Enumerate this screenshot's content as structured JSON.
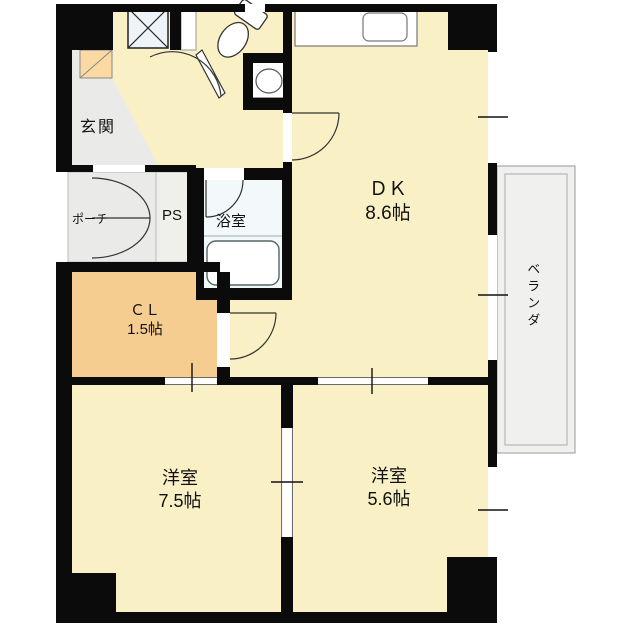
{
  "floorplan": {
    "type": "apartment-floorplan",
    "rooms": {
      "genkan": {
        "name": "玄関"
      },
      "porch": {
        "name": "ポーチ"
      },
      "pipe_space": {
        "name": "PS"
      },
      "bathroom": {
        "name": "浴室"
      },
      "closet": {
        "name": "ＣＬ",
        "size": "1.5帖"
      },
      "dining_kitchen": {
        "name": "ＤＫ",
        "size": "8.6帖"
      },
      "western_room_large": {
        "name": "洋室",
        "size": "7.5帖"
      },
      "western_room_small": {
        "name": "洋室",
        "size": "5.6帖"
      },
      "veranda": {
        "name": "ベランダ"
      }
    },
    "fixtures": [
      "toilet-icon",
      "washbasin-icon",
      "bathtub-icon",
      "kitchen-counter-icon",
      "kitchen-sink-icon",
      "washing-machine-space-icon",
      "shoe-cabinet-icon",
      "door-swing-arc",
      "window-opening"
    ],
    "colors": {
      "wall": "#0b0b0b",
      "room_cream": "#faf0c6",
      "closet_orange": "#f6cd90",
      "entry_gray": "#eaeae8",
      "bath_white": "#f3f8fa",
      "veranda_gray": "#f0f0ee",
      "shoe_cabinet": "#fad9a3",
      "washer_nook": "#edf3f7"
    }
  }
}
